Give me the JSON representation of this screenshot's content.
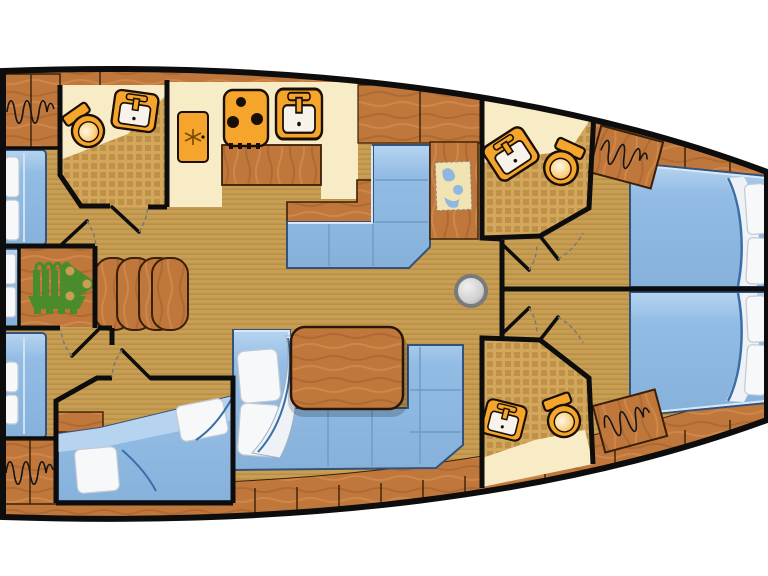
{
  "title": "Sailing yacht interior deck plan",
  "colors": {
    "hullOutline": "#0d0d0d",
    "floor": "#c79e52",
    "floorStripe": "#b78f49",
    "wood": "#c0773c",
    "woodDark": "#a2602c",
    "woodLight": "#d58d4f",
    "woodEdge": "#3a2008",
    "cream": "#f7ecc6",
    "checker": "#d2a75c",
    "checkerDark": "#bf9148",
    "bed": "#92bce4",
    "bedLight": "#b6d4f0",
    "bedEdge": "#35537a",
    "pillow": "#f7f8fa",
    "fixture": "#f5a52b",
    "fixtureEdge": "#1a0f05",
    "basin": "#f7f3ea",
    "engine": "#4a8c2b",
    "post": "#9a9a9a",
    "mapPaper": "#f2e3b3",
    "mapWater": "#8fb8e0",
    "doorArc": "#777777"
  },
  "rooms": {
    "hull": "Yacht hull",
    "bow_cabin_starboard": "Bow cabin (starboard)",
    "bow_cabin_port": "Bow cabin (port)",
    "bathroom_bow_starboard": "En-suite bathroom (starboard bow)",
    "bathroom_bow_port": "En-suite bathroom (port bow)",
    "salon": "Salon",
    "galley": "Galley",
    "nav_station": "Navigation station",
    "bathroom_aft": "Aft bathroom",
    "aft_cabin_starboard": "Aft cabin (starboard)",
    "aft_cabin_port": "Aft cabin (port)",
    "crew_berth": "Stern crew berth",
    "engine_room": "Engine room",
    "companionway": "Companionway steps",
    "corridor_bow": "Bow corridor"
  },
  "fixtures": {
    "stove": "3-burner stove",
    "fridge": "Refrigerator",
    "galley_sink": "Galley sink",
    "sink": "Washbasin",
    "toilet": "Marine toilet",
    "table": "Salon table",
    "settee_upper": "Salon settee (starboard)",
    "settee_lower": "Salon settee (port, U-shaped)",
    "bed": "Double berth",
    "mast_post": "Mast compression post",
    "chart": "Chart table with sea map",
    "hanging_locker": "Hanging locker",
    "engine": "Engine",
    "steps": "Companionway steps"
  }
}
